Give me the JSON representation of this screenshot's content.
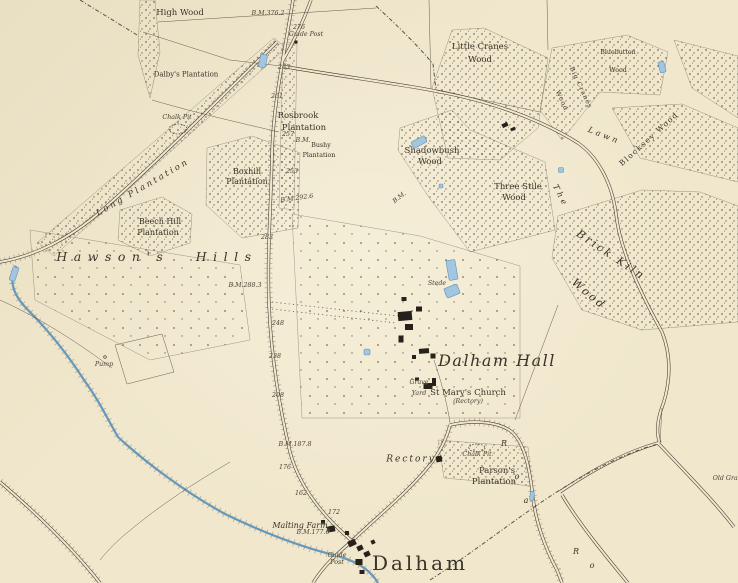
{
  "palette": {
    "paper": "#f0e7cc",
    "ink": "#3f3930",
    "stipple": "#6d6453",
    "wood_edge": "#554e41",
    "water_line": "#5f93bb",
    "water_fill": "#a3c6e0",
    "building": "#26221b",
    "text": "#39332a"
  },
  "labels": [
    {
      "text": "High Wood",
      "x": 180,
      "y": 13,
      "cls": "nm"
    },
    {
      "text": "B.M.376.2",
      "x": 268,
      "y": 14,
      "cls": "num"
    },
    {
      "text": "276",
      "x": 299,
      "y": 28,
      "cls": "num"
    },
    {
      "text": "Guide Post",
      "x": 306,
      "y": 35,
      "cls": "num"
    },
    {
      "text": "Dalby's Plantation",
      "x": 186,
      "y": 75,
      "cls": "nxs"
    },
    {
      "text": "263",
      "x": 284,
      "y": 68,
      "cls": "num"
    },
    {
      "text": "261",
      "x": 277,
      "y": 97,
      "cls": "num"
    },
    {
      "text": "Rosbrook",
      "x": 298,
      "y": 116,
      "cls": "nm"
    },
    {
      "text": "Plantation",
      "x": 304,
      "y": 128,
      "cls": "nm"
    },
    {
      "text": "Chalk Pit",
      "x": 177,
      "y": 118,
      "cls": "num"
    },
    {
      "text": "257",
      "x": 288,
      "y": 135,
      "cls": "num"
    },
    {
      "text": "B.M.",
      "x": 303,
      "y": 141,
      "cls": "num"
    },
    {
      "text": "Bushy",
      "x": 321,
      "y": 146,
      "cls": "nxxs"
    },
    {
      "text": "Plantation",
      "x": 319,
      "y": 156,
      "cls": "nxxs"
    },
    {
      "text": "253",
      "x": 292,
      "y": 172,
      "cls": "num"
    },
    {
      "text": "B.M.292.6",
      "x": 297,
      "y": 199,
      "cls": "num",
      "rot": -8
    },
    {
      "text": "Boxhill",
      "x": 247,
      "y": 172,
      "cls": "nsm"
    },
    {
      "text": "Plantation",
      "x": 247,
      "y": 182,
      "cls": "nsm"
    },
    {
      "text": "Long Plantation",
      "x": 143,
      "y": 188,
      "cls": "spread",
      "rot": -30
    },
    {
      "text": "Beech Hill",
      "x": 160,
      "y": 222,
      "cls": "nsm"
    },
    {
      "text": "Plantation",
      "x": 158,
      "y": 233,
      "cls": "nsm"
    },
    {
      "text": "Hawson's Hills",
      "x": 157,
      "y": 257,
      "cls": "hills"
    },
    {
      "text": "283",
      "x": 267,
      "y": 238,
      "cls": "num"
    },
    {
      "text": "B.M.288.3",
      "x": 245,
      "y": 286,
      "cls": "num"
    },
    {
      "text": "248",
      "x": 278,
      "y": 324,
      "cls": "num"
    },
    {
      "text": "238",
      "x": 275,
      "y": 357,
      "cls": "num"
    },
    {
      "text": "208",
      "x": 278,
      "y": 396,
      "cls": "num"
    },
    {
      "text": "Little Cranes",
      "x": 480,
      "y": 47,
      "cls": "nm"
    },
    {
      "text": "Wood",
      "x": 480,
      "y": 60,
      "cls": "nm"
    },
    {
      "text": "Bluebutton",
      "x": 618,
      "y": 53,
      "cls": "nxxs"
    },
    {
      "text": "Wood",
      "x": 618,
      "y": 71,
      "cls": "nxxs"
    },
    {
      "text": "Big Cranes",
      "x": 580,
      "y": 88,
      "cls": "nvert",
      "rot": 65
    },
    {
      "text": "Wood",
      "x": 561,
      "y": 101,
      "cls": "nvert",
      "rot": 65
    },
    {
      "text": "Blocksey Wood",
      "x": 649,
      "y": 139,
      "cls": "ndiag",
      "rot": -42
    },
    {
      "text": "The",
      "x": 560,
      "y": 196,
      "cls": "lawn",
      "rot": 63
    },
    {
      "text": "Lawn",
      "x": 604,
      "y": 136,
      "cls": "lawn",
      "rot": 22
    },
    {
      "text": "Shadowbush",
      "x": 432,
      "y": 151,
      "cls": "nm"
    },
    {
      "text": "Wood",
      "x": 430,
      "y": 162,
      "cls": "nm"
    },
    {
      "text": "B.M.",
      "x": 400,
      "y": 198,
      "cls": "num",
      "rot": -38
    },
    {
      "text": "Three Stile",
      "x": 518,
      "y": 187,
      "cls": "nm"
    },
    {
      "text": "Wood",
      "x": 514,
      "y": 198,
      "cls": "nm"
    },
    {
      "text": "Brick Kiln",
      "x": 611,
      "y": 255,
      "cls": "bigdiag",
      "rot": 34
    },
    {
      "text": "Wood",
      "x": 589,
      "y": 294,
      "cls": "bigdiag",
      "rot": 40
    },
    {
      "text": "Stede",
      "x": 437,
      "y": 284,
      "cls": "num"
    },
    {
      "text": "Dalham Hall",
      "x": 497,
      "y": 361,
      "cls": "hall"
    },
    {
      "text": "Grave",
      "x": 419,
      "y": 383,
      "cls": "num"
    },
    {
      "text": "Yard",
      "x": 419,
      "y": 394,
      "cls": "num"
    },
    {
      "text": "St Mary's Church",
      "x": 468,
      "y": 393,
      "cls": "nm"
    },
    {
      "text": "(Rectory)",
      "x": 468,
      "y": 402,
      "cls": "num"
    },
    {
      "text": "Rectory",
      "x": 411,
      "y": 460,
      "cls": "itspread"
    },
    {
      "text": "Chalk Pit",
      "x": 477,
      "y": 455,
      "cls": "num"
    },
    {
      "text": "Parson's",
      "x": 497,
      "y": 471,
      "cls": "nm"
    },
    {
      "text": "Plantation",
      "x": 494,
      "y": 482,
      "cls": "nm"
    },
    {
      "text": "B.M.187.8",
      "x": 295,
      "y": 445,
      "cls": "num"
    },
    {
      "text": "176",
      "x": 285,
      "y": 468,
      "cls": "num"
    },
    {
      "text": "162",
      "x": 301,
      "y": 494,
      "cls": "num"
    },
    {
      "text": "172",
      "x": 334,
      "y": 513,
      "cls": "num"
    },
    {
      "text": "Malting Farm",
      "x": 300,
      "y": 526,
      "cls": "it"
    },
    {
      "text": "B.M.177.6",
      "x": 313,
      "y": 533,
      "cls": "num"
    },
    {
      "text": "Guide",
      "x": 337,
      "y": 556,
      "cls": "num"
    },
    {
      "text": "Post",
      "x": 337,
      "y": 563,
      "cls": "num"
    },
    {
      "text": "Dalham",
      "x": 420,
      "y": 563,
      "cls": "town"
    },
    {
      "text": "Pump",
      "x": 104,
      "y": 365,
      "cls": "num"
    },
    {
      "text": "Old Grav",
      "x": 727,
      "y": 479,
      "cls": "num"
    },
    {
      "text": "R",
      "x": 504,
      "y": 444,
      "cls": "rl"
    },
    {
      "text": "o",
      "x": 517,
      "y": 477,
      "cls": "rl"
    },
    {
      "text": "a",
      "x": 526,
      "y": 501,
      "cls": "rl"
    },
    {
      "text": "R",
      "x": 576,
      "y": 552,
      "cls": "rl"
    },
    {
      "text": "o",
      "x": 592,
      "y": 566,
      "cls": "rl"
    }
  ],
  "features": {
    "woods": [
      {
        "points": "140,0 155,0 160,52 150,98 138,55",
        "density": "dense"
      },
      {
        "points": "274,38 286,48 54,256 38,242",
        "density": "dense"
      },
      {
        "points": "283,42 297,44 294,210 279,208",
        "density": "dense"
      },
      {
        "points": "207,148 252,136 300,153 298,228 242,238 206,205",
        "density": "dense"
      },
      {
        "points": "120,210 162,197 192,214 190,243 150,256 118,240",
        "density": "dense"
      },
      {
        "points": "432,88 452,30 484,28 548,58 538,128 500,160 448,158",
        "density": "dense"
      },
      {
        "points": "552,48 627,35 668,52 660,95 600,92 562,140 540,110",
        "density": "dense"
      },
      {
        "points": "612,108 682,104 738,128 738,182 640,158",
        "density": "dense"
      },
      {
        "points": "674,40 738,56 738,118 692,88",
        "density": "dense"
      },
      {
        "points": "400,128 452,110 470,130 545,162 555,230 470,252 428,196 398,150",
        "density": "dense"
      },
      {
        "points": "558,216 642,190 700,192 738,206 738,322 642,330 582,310 552,258",
        "density": "dense"
      },
      {
        "points": "438,440 528,447 532,486 444,478",
        "density": "dense"
      },
      {
        "points": "292,214 420,236 520,266 520,418 302,418",
        "density": "sparse"
      },
      {
        "points": "30,230 240,265 250,340 150,360 35,300",
        "density": "sparse"
      }
    ],
    "stream": {
      "d": "M16,266 C8,282 14,296 28,310 C48,330 66,352 84,380 C100,402 108,420 118,437 C145,462 185,492 225,514 C258,530 295,545 330,554 C350,559 368,566 378,583"
    },
    "roads": [
      {
        "d": "M293,0 C284,55 273,105 272,155 C271,205 267,255 269,305 C271,355 279,405 290,452 C298,482 318,512 352,541",
        "trees": true
      },
      {
        "d": "M311,0 C303,22 292,45 282,62",
        "trees": false
      },
      {
        "d": "M277,42 C240,78 160,160 100,212 C70,238 35,256 0,262",
        "trees": true
      },
      {
        "d": "M281,66 C350,78 410,85 455,95 C505,106 548,124 578,143 C598,157 612,183 616,214 C620,250 640,292 662,332 C674,362 668,392 661,410 C656,426 657,436 660,443",
        "trees": false
      },
      {
        "d": "M352,541 C378,516 408,492 429,466 C441,451 447,437 450,425",
        "trees": true
      },
      {
        "d": "M450,425 C472,420 498,421 512,432 C525,444 530,470 533,498 C536,522 545,548 557,570 L562,583",
        "trees": true
      },
      {
        "d": "M560,492 C592,470 626,452 658,443 C690,477 714,501 734,527",
        "trees": false
      },
      {
        "d": "M562,495 C580,525 605,555 628,583",
        "trees": false
      },
      {
        "d": "M352,541 C338,553 324,565 313,583",
        "trees": false
      },
      {
        "d": "M0,482 C35,512 70,545 100,583",
        "trees": true
      }
    ],
    "hedges": [
      "M143,32 L230,60 L281,66",
      "M158,22 L376,8",
      "M152,100 C200,114 245,124 279,132",
      "M429,0 L431,88",
      "M547,0 L548,50",
      "M436,90 L540,112",
      "M558,305 L515,420",
      "M450,422 C446,398 440,378 434,360",
      "M115,345 L162,334 L174,372 L127,384 Z",
      "M660,443 L662,408",
      "M230,462 C196,482 160,505 128,532 C118,540 108,550 100,560",
      "M0,300 C40,318 80,344 112,368"
    ],
    "boundaries": [
      "M430,580 C480,548 520,515 560,490 C595,468 628,452 658,444",
      "M80,0 L137,35",
      "M376,6 C400,28 420,48 433,64 L436,90"
    ],
    "avenue": [
      "M272,302 L398,316",
      "M272,309 L396,323"
    ],
    "ponds": [
      [
        263,
        61,
        7,
        13,
        12
      ],
      [
        452,
        270,
        9,
        20,
        -10
      ],
      [
        452,
        291,
        14,
        10,
        -22
      ],
      [
        419,
        142,
        15,
        7,
        -28
      ],
      [
        441,
        186,
        4,
        4,
        0
      ],
      [
        561,
        170,
        5,
        5,
        0
      ],
      [
        662,
        67,
        6,
        11,
        -15
      ],
      [
        367,
        352,
        6,
        6,
        0
      ],
      [
        532,
        496,
        4,
        9,
        6
      ],
      [
        14,
        274,
        6,
        14,
        18
      ]
    ],
    "buildings": [
      [
        405,
        316,
        14,
        9,
        -5
      ],
      [
        409,
        327,
        8,
        6,
        0
      ],
      [
        419,
        309,
        6,
        5,
        0
      ],
      [
        401,
        339,
        5,
        7,
        0
      ],
      [
        424,
        351,
        10,
        5,
        -4
      ],
      [
        433,
        356,
        5,
        5,
        0
      ],
      [
        414,
        357,
        4,
        4,
        0
      ],
      [
        404,
        299,
        5,
        4,
        0
      ],
      [
        428,
        386,
        9,
        6,
        0
      ],
      [
        434,
        382,
        4,
        8,
        0
      ],
      [
        417,
        379,
        4,
        3,
        0
      ],
      [
        439,
        459,
        6,
        6,
        -10
      ],
      [
        352,
        543,
        8,
        6,
        -25
      ],
      [
        360,
        548,
        6,
        5,
        -25
      ],
      [
        367,
        554,
        6,
        5,
        -25
      ],
      [
        359,
        562,
        7,
        6,
        0
      ],
      [
        347,
        533,
        4,
        4,
        0
      ],
      [
        373,
        542,
        4,
        4,
        -25
      ],
      [
        362,
        572,
        5,
        4,
        0
      ],
      [
        331,
        529,
        8,
        6,
        -10
      ],
      [
        323,
        522,
        4,
        4,
        0
      ],
      [
        505,
        125,
        6,
        4,
        -25
      ],
      [
        513,
        129,
        5,
        3,
        -25
      ],
      [
        296,
        42,
        3,
        3,
        0
      ]
    ],
    "chalk_pits": [
      [
        178,
        129,
        9,
        5
      ],
      [
        477,
        448,
        8,
        4
      ]
    ],
    "pump_symbol": [
      105,
      357
    ]
  }
}
